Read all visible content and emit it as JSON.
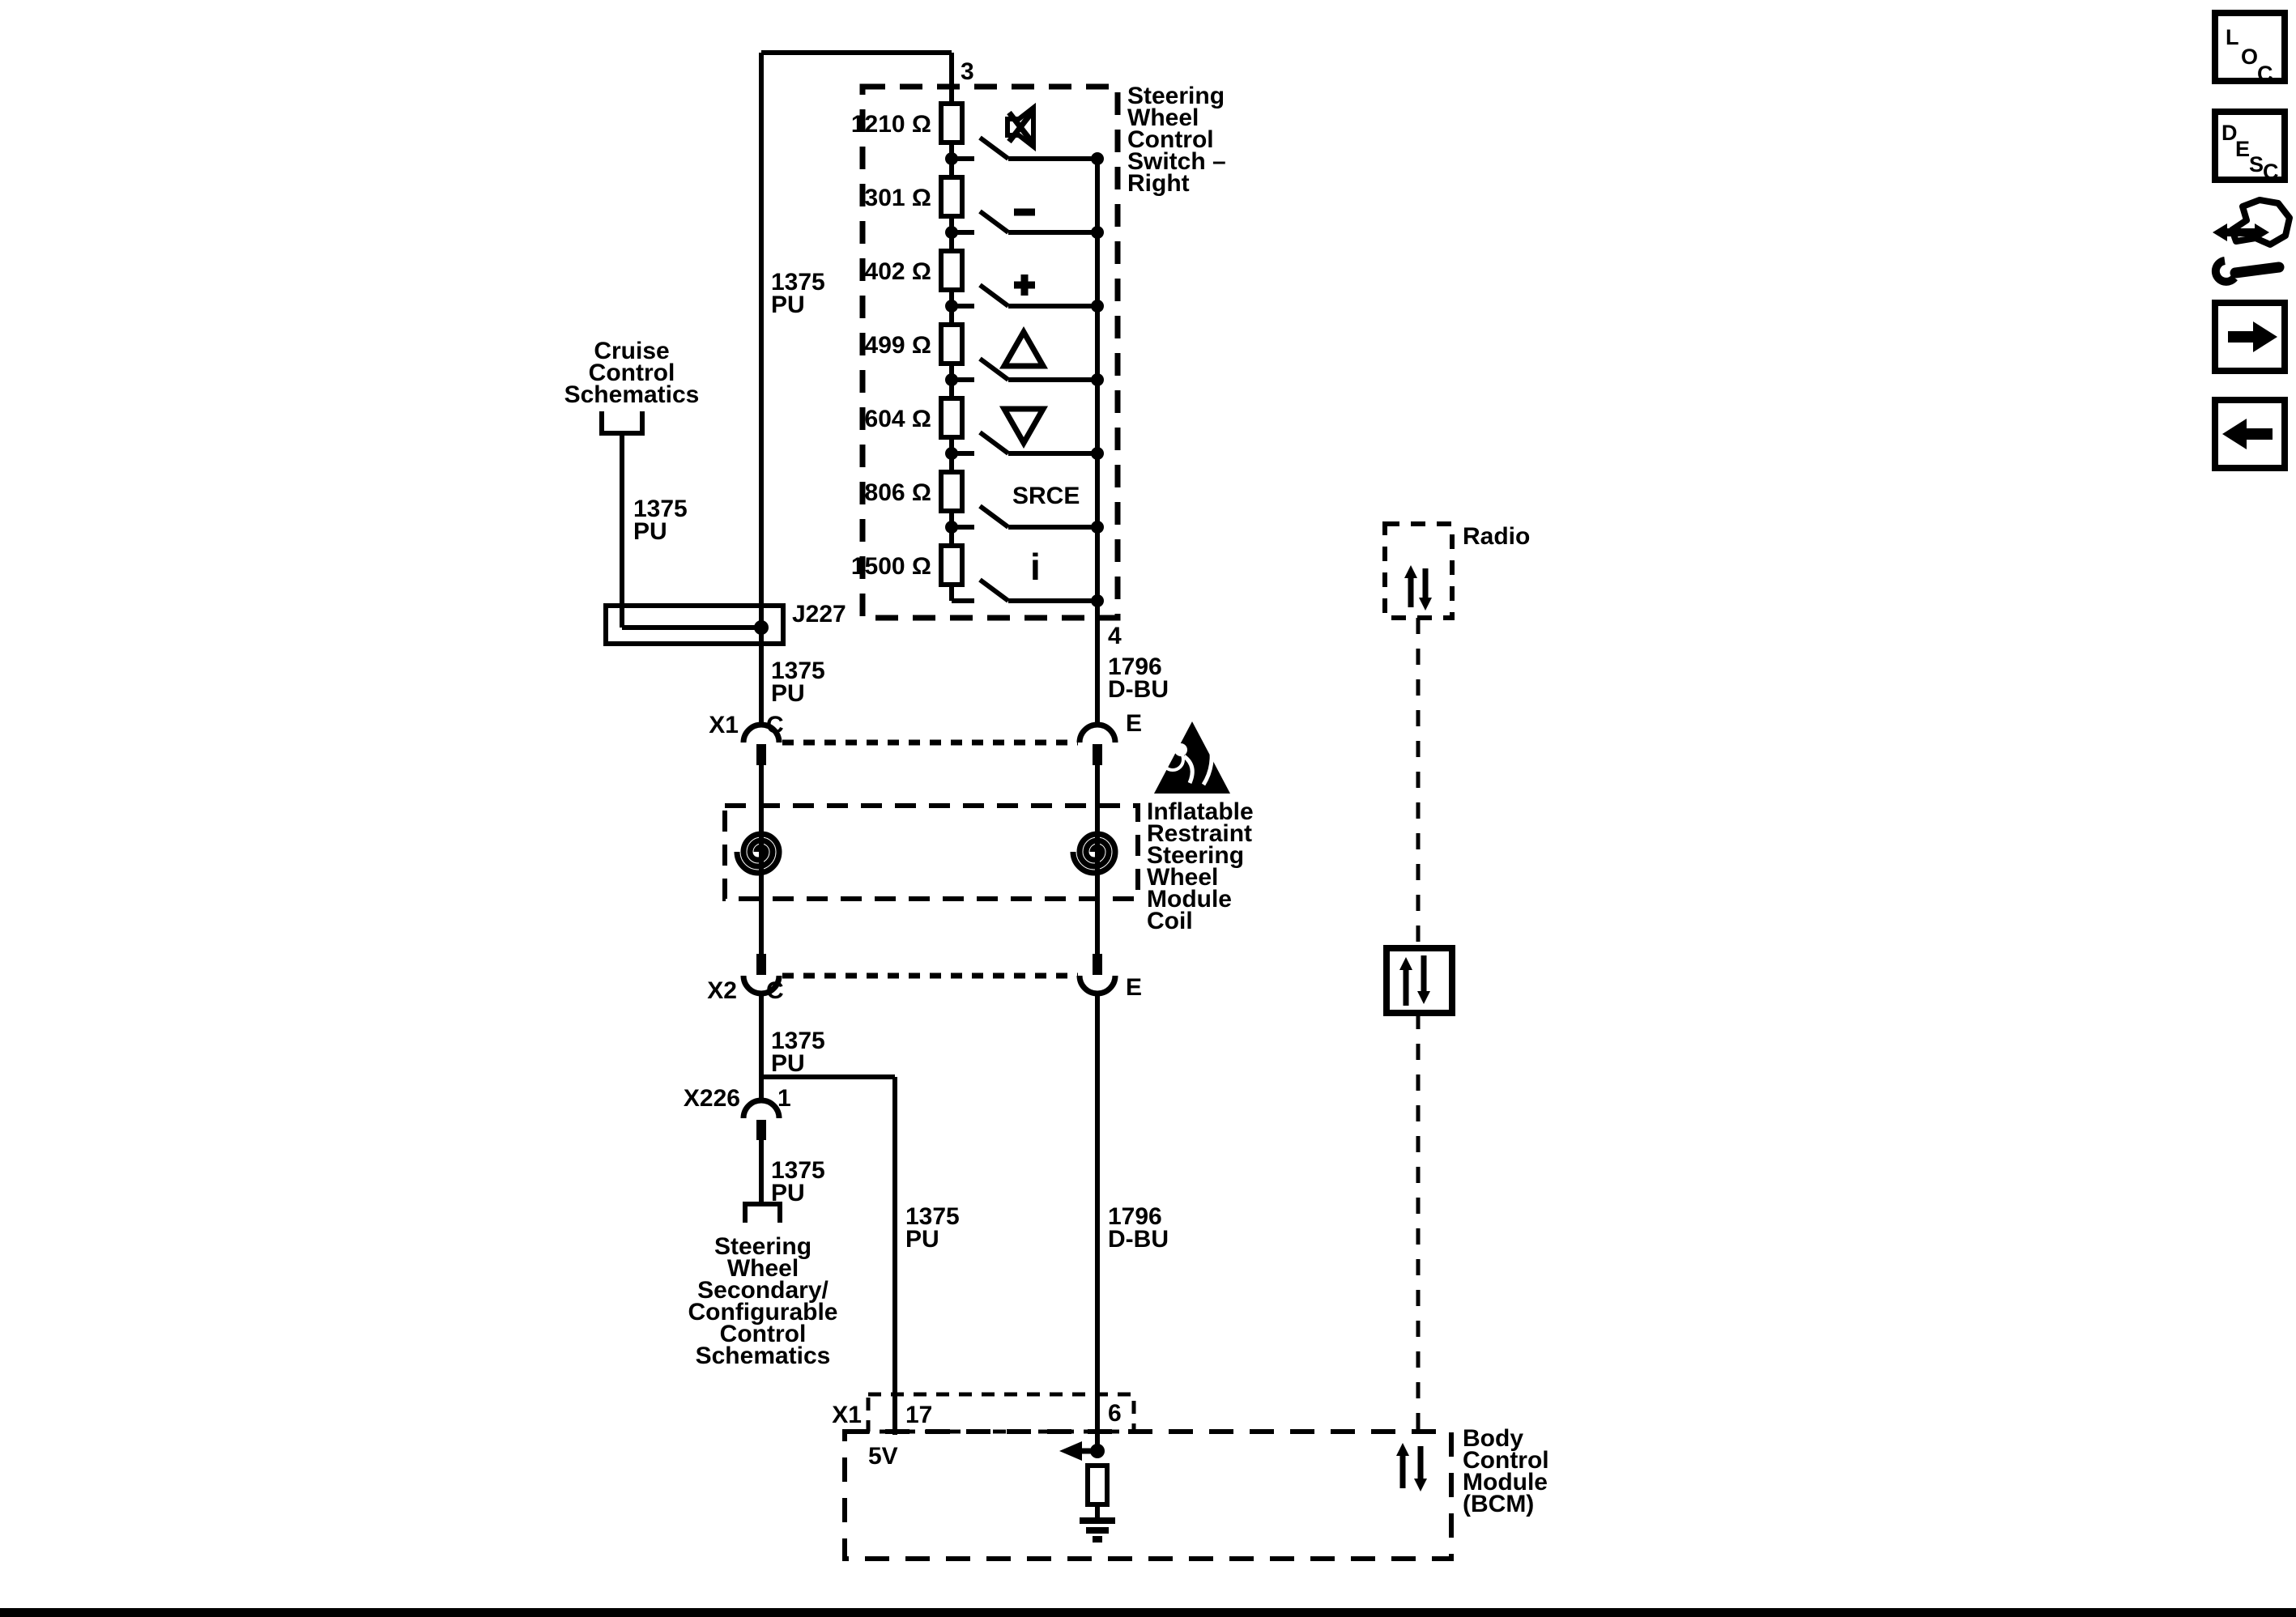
{
  "switch": {
    "name": [
      "Steering",
      "Wheel",
      "Control",
      "Switch –",
      "Right"
    ],
    "resistors": [
      "1210 Ω",
      "301 Ω",
      "402 Ω",
      "499 Ω",
      "604 Ω",
      "806 Ω",
      "1500 Ω"
    ],
    "srce": "SRCE",
    "info": "i",
    "pin_top": "3",
    "pin_bottom": "4"
  },
  "wire_pu": {
    "num": "1375",
    "color": "PU"
  },
  "wire_dbu": {
    "num": "1796",
    "color": "D-BU"
  },
  "cruise": {
    "lines": [
      "Cruise",
      "Control",
      "Schematics"
    ]
  },
  "splice": {
    "id": "J227"
  },
  "connector_x1": {
    "id": "X1",
    "pin_c": "C",
    "pin_e": "E"
  },
  "connector_x2": {
    "id": "X2",
    "pin_c": "C",
    "pin_e": "E"
  },
  "connector_x226": {
    "id": "X226",
    "pin_1": "1"
  },
  "coil_module": {
    "lines": [
      "Inflatable",
      "Restraint",
      "Steering",
      "Wheel",
      "Module",
      "Coil"
    ]
  },
  "secondary": {
    "lines": [
      "Steering",
      "Wheel",
      "Secondary/",
      "Configurable",
      "Control",
      "Schematics"
    ]
  },
  "radio": {
    "label": "Radio"
  },
  "bcm": {
    "lines": [
      "Body",
      "Control",
      "Module",
      "(BCM)"
    ],
    "conn": "X1",
    "pin_17": "17",
    "pin_6": "6",
    "ref_5v": "5V"
  },
  "toolbar": {
    "loc": [
      "L",
      "O",
      "C"
    ],
    "desc": [
      "D",
      "E",
      "S",
      "C"
    ]
  }
}
